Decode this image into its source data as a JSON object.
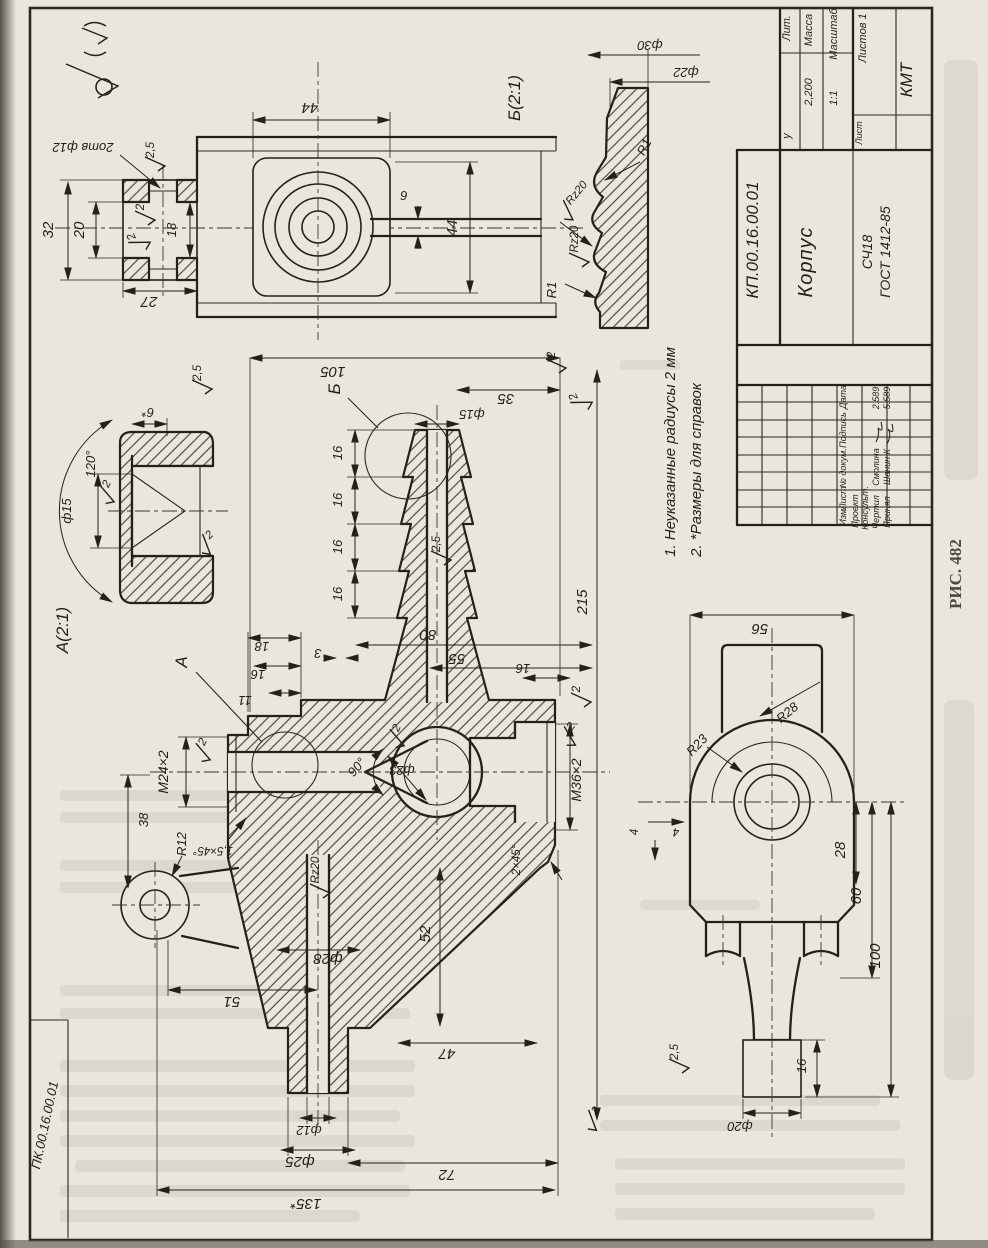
{
  "figure_caption": "РИС. 482",
  "corner_stamp": "ПК.00.16.00.01",
  "notes": [
    "1. Неуказанные радиусы 2 мм",
    "2. *Размеры для справок"
  ],
  "title_block": {
    "designation": "КП.00.16.00.01",
    "part_name": "Корпус",
    "material_line1": "СЧ18",
    "material_line2": "ГОСТ 1412-85",
    "organization": "КМТ",
    "lit_label": "Лит.",
    "lit_value": "у",
    "mass_label": "Масса",
    "mass_value": "2,200",
    "scale_label": "Масштаб",
    "scale_value": "1:1",
    "sheet_label": "Лист",
    "sheets_label": "Листов 1",
    "columns": {
      "izm": "Изм.",
      "list": "Лист",
      "doc": "№ докум.",
      "sign": "Подпись",
      "date": "Дата"
    },
    "rows": {
      "r1": "Проект",
      "r2": "Консульт.",
      "r3": "Чертил",
      "r3_name": "Смолина",
      "r3_date": "2.589",
      "r4": "Принял",
      "r4_name": "Шанин К",
      "r4_date": "5.589"
    }
  },
  "views": {
    "detail_a": "А(2:1)",
    "detail_b": "Б(2:1)",
    "callout_a": "А",
    "callout_b": "Б"
  },
  "dims": {
    "n105": "105",
    "n35": "35",
    "d15": "ф15",
    "n16": "16",
    "r2_5": "2,5",
    "n80": "80",
    "n55": "55",
    "n3": "3",
    "n215": "215",
    "n18": "18",
    "n11": "11",
    "m24": "М24×2",
    "ch15": "1,5×45°",
    "a90": "90°",
    "d23": "ф23",
    "rz20": "Rz20",
    "d28": "ф28",
    "n52": "52",
    "n47": "47",
    "n51": "51",
    "n38": "38",
    "r12": "R12",
    "d12": "ф12",
    "d25": "ф25",
    "n135": "135*",
    "n72": "72",
    "n44": "44",
    "n6": "6",
    "n32": "32",
    "n20": "20",
    "n27": "27",
    "holes2": "2отв ф12",
    "d30": "ф30",
    "d22": "ф22",
    "r1": "R1",
    "n56": "56",
    "r28": "R28",
    "r23": "R23",
    "n4": "4",
    "n28": "28",
    "n60": "60",
    "n100": "100",
    "d20": "ф20",
    "m36": "М36×2",
    "ch2": "2×45°",
    "n6s": "6*",
    "a120": "120°",
    "n2": "2"
  }
}
